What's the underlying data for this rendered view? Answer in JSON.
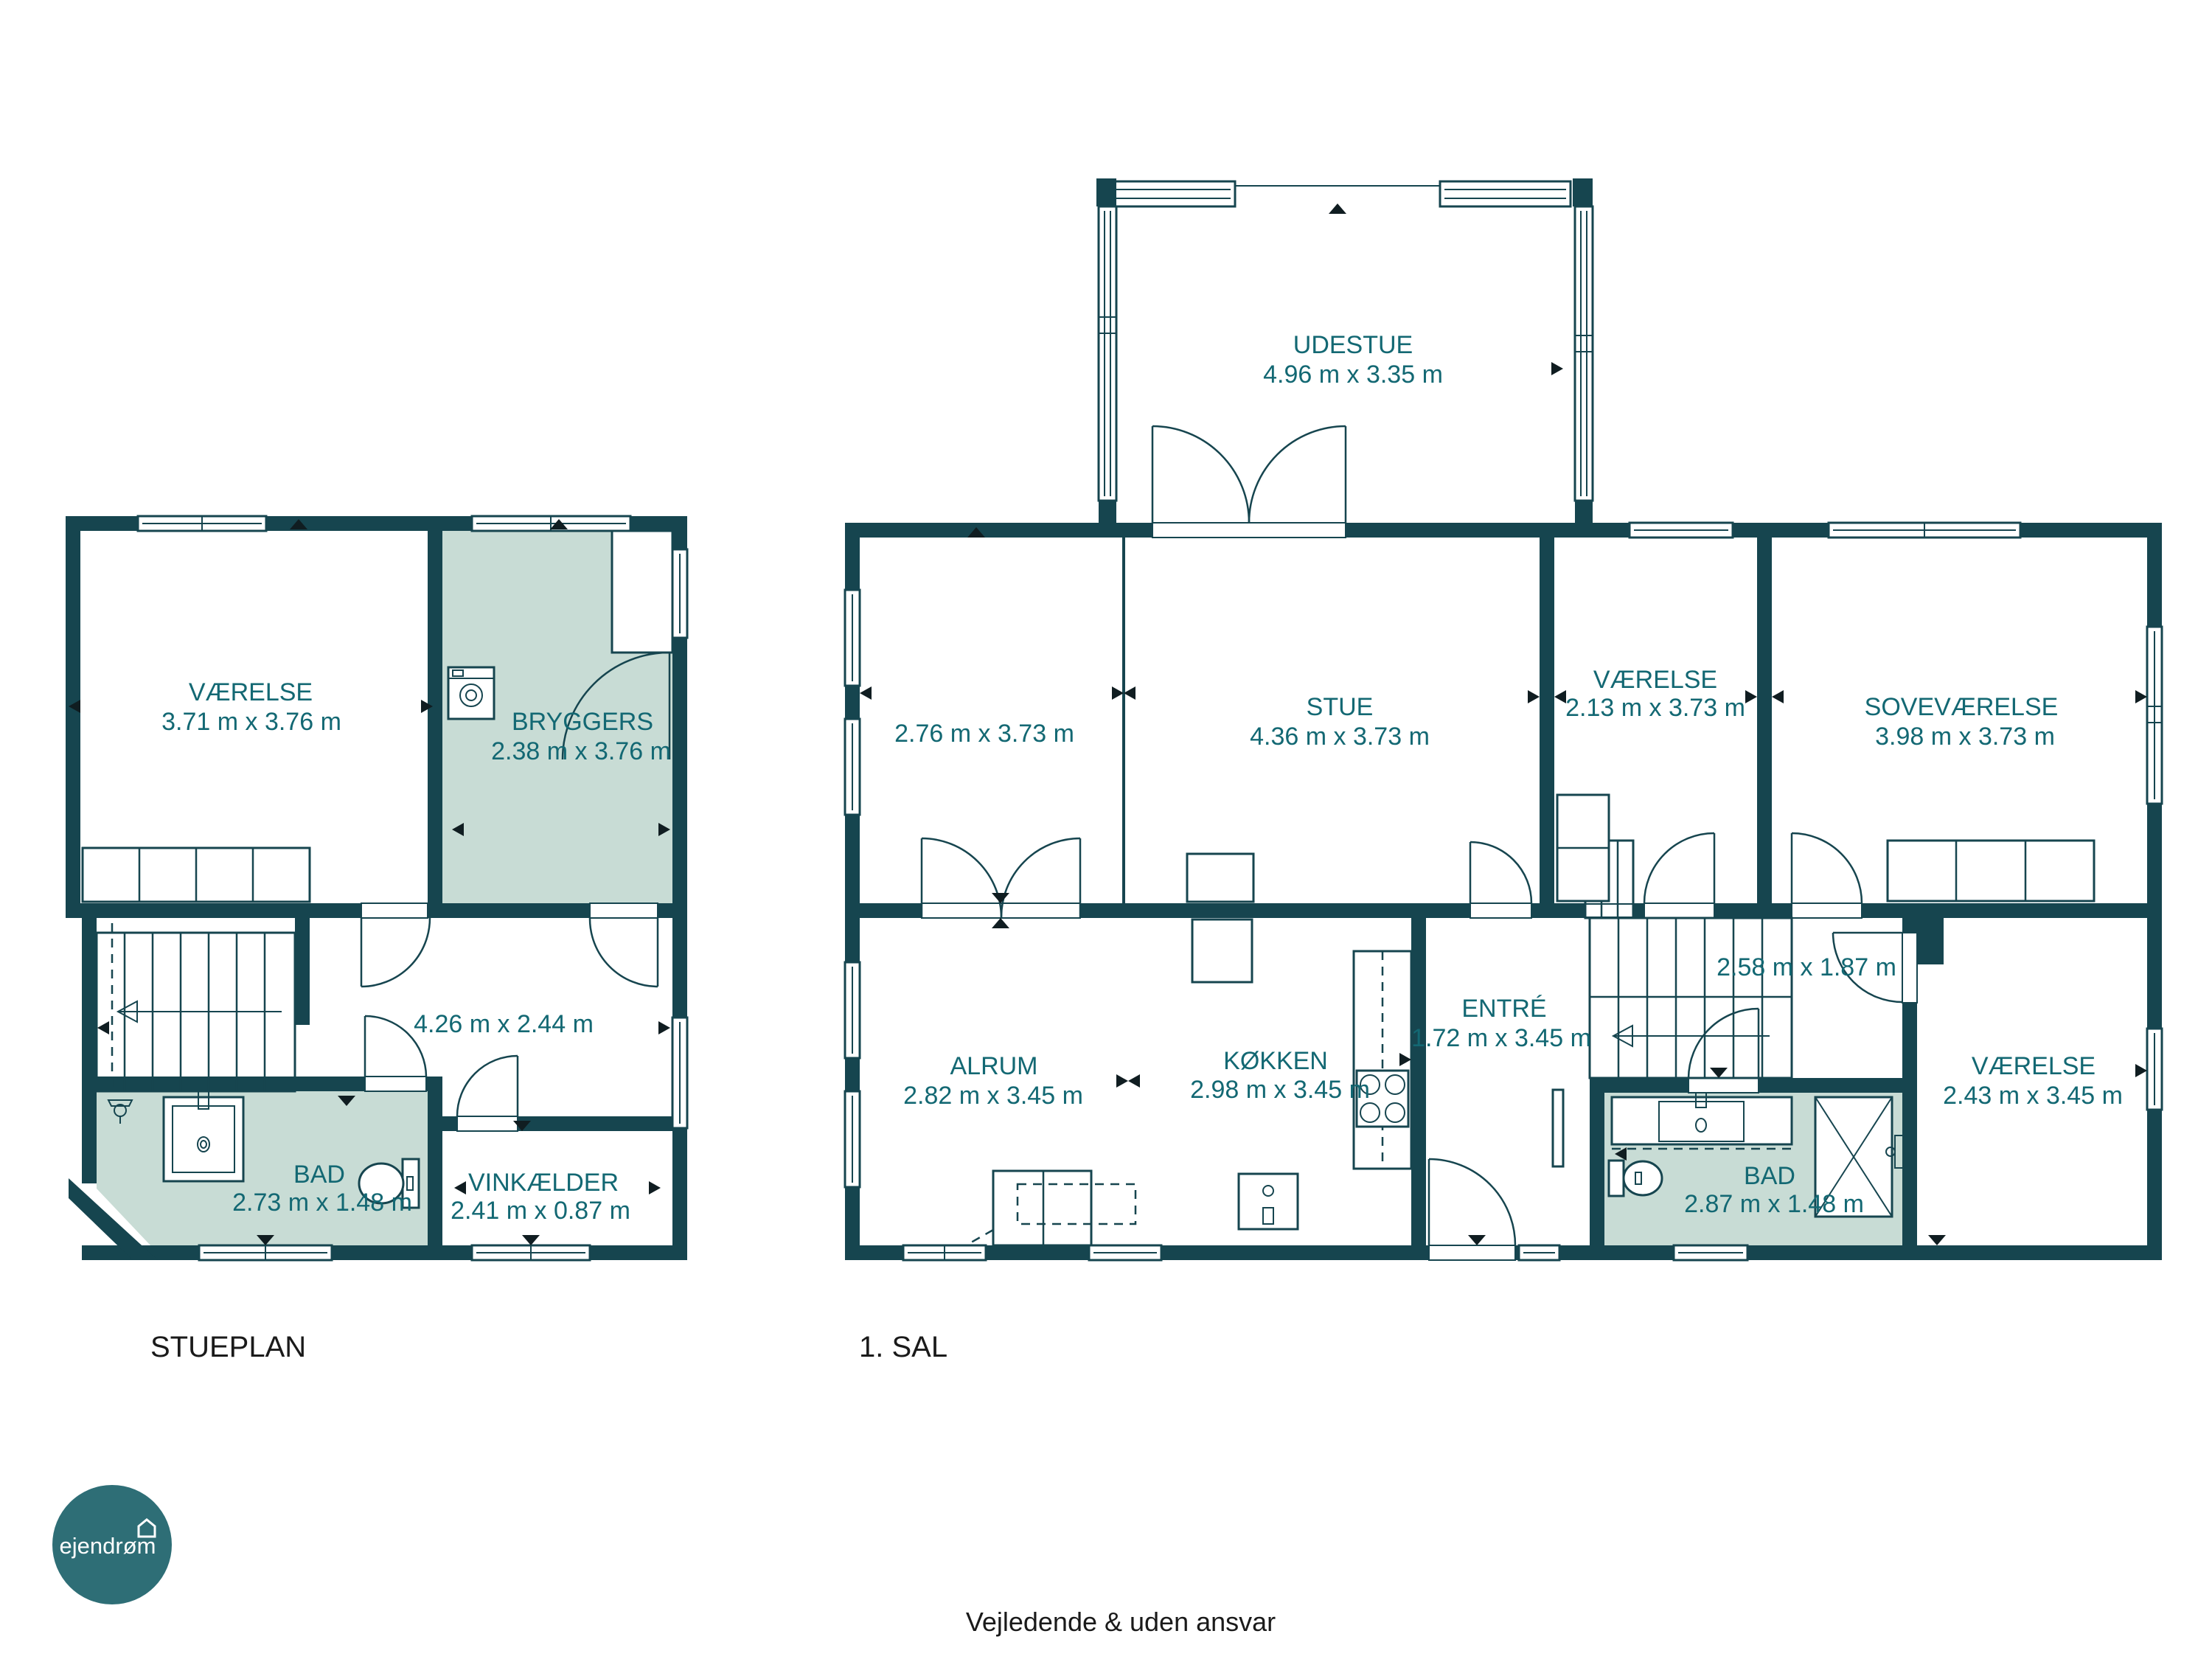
{
  "colors": {
    "wall": "#16454f",
    "highlight_room_fill": "#c8dcd5",
    "room_label": "#136873",
    "title_text": "#1a1a1a",
    "logo_background": "#2e6e76",
    "logo_text": "#ffffff"
  },
  "plans": [
    {
      "title": "STUEPLAN",
      "rooms": [
        {
          "name": "VÆRELSE",
          "dims": "3.71 m x 3.76 m"
        },
        {
          "name": "BRYGGERS",
          "dims": "2.38 m x 3.76 m"
        },
        {
          "name": "",
          "dims": "4.26 m x 2.44 m"
        },
        {
          "name": "BAD",
          "dims": "2.73 m x 1.48 m"
        },
        {
          "name": "VINKÆLDER",
          "dims": "2.41 m x 0.87 m"
        }
      ]
    },
    {
      "title": "1. SAL",
      "rooms": [
        {
          "name": "UDESTUE",
          "dims": "4.96 m x 3.35 m"
        },
        {
          "name": "",
          "dims": "2.76 m x 3.73 m"
        },
        {
          "name": "STUE",
          "dims": "4.36 m x 3.73 m"
        },
        {
          "name": "VÆRELSE",
          "dims": "2.13 m x 3.73 m"
        },
        {
          "name": "SOVEVÆRELSE",
          "dims": "3.98 m x 3.73 m"
        },
        {
          "name": "ALRUM",
          "dims": "2.82 m x 3.45 m"
        },
        {
          "name": "KØKKEN",
          "dims": "2.98 m x 3.45 m"
        },
        {
          "name": "ENTRÉ",
          "dims": "1.72 m x 3.45 m"
        },
        {
          "name": "",
          "dims": "2.58 m x 1.87 m"
        },
        {
          "name": "BAD",
          "dims": "2.87 m x 1.48 m"
        },
        {
          "name": "VÆRELSE",
          "dims": "2.43 m x 3.45 m"
        }
      ]
    }
  ],
  "footer": {
    "disclaimer": "Vejledende & uden ansvar"
  },
  "logo": {
    "text": "ejendrøm"
  }
}
